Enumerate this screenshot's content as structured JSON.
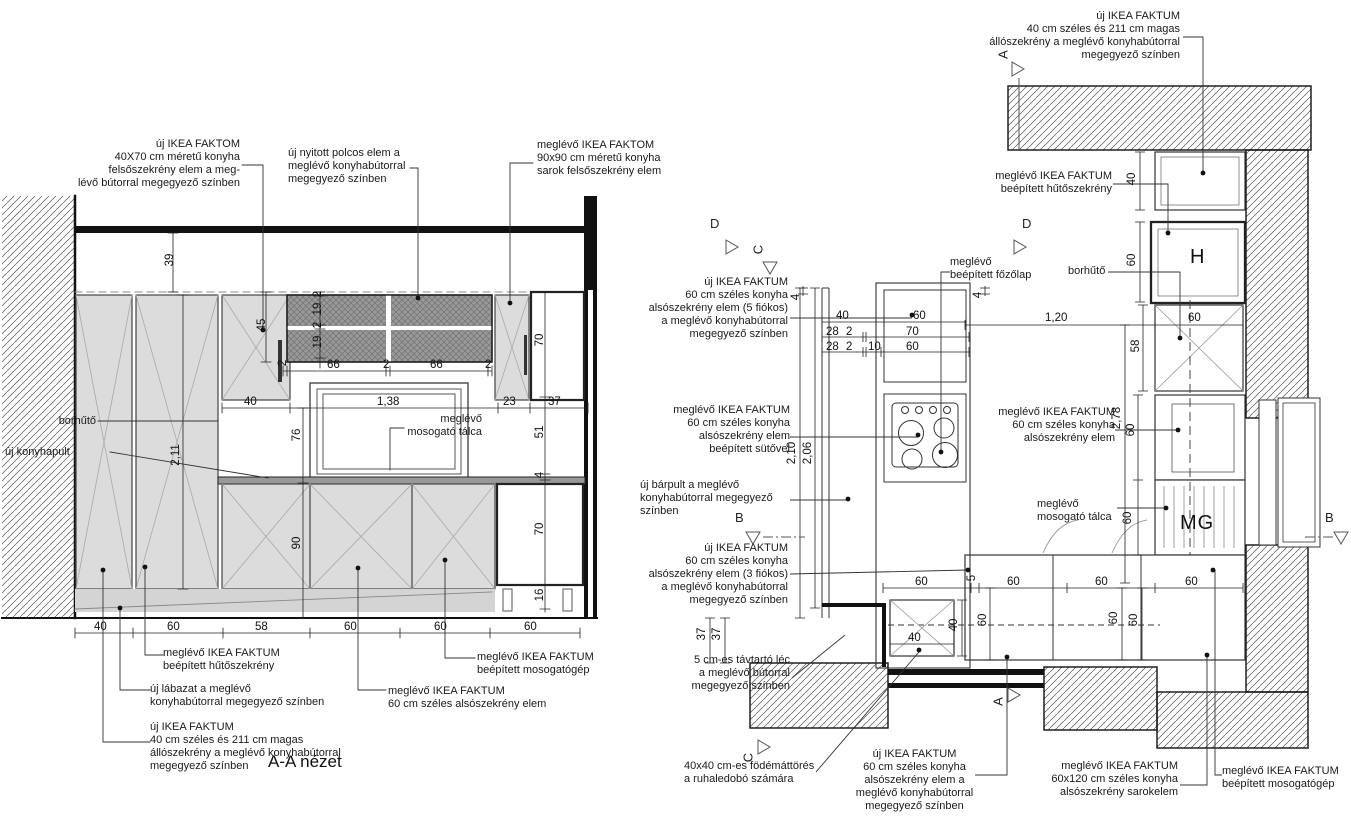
{
  "left": {
    "title": "A-A nézet",
    "ann": {
      "upper40": "új IKEA FAKTOM\n40X70 cm méretű konyha\nfelsőszekrény elem a meg-\nlévő bútorral megegyező színben",
      "openShelf": "új nyitott polcos elem a\nmeglévő konyhabútorral\nmegegyező színben",
      "corner90": "meglévő IKEA FAKTOM\n90x90 cm méretű konyha\nsarok felsőszekrény elem",
      "borhuto": "borhűtő",
      "konyhapult": "új konyhapult",
      "talca": "meglévő\nmosogató tálca",
      "huto": "meglévő IKEA FAKTUM\nbeépített hűtőszekrény",
      "labazat": "új lábazat a meglévő\nkonyhabútorral megegyező színben",
      "allo": "új IKEA FAKTUM\n40 cm széles és 211 cm magas\nállószekrény a meglévő konyhabútorral\nmegegyező színben",
      "mosogep": "meglévő IKEA FAKTUM\nbeépített mosogatógép",
      "also60": "meglévő IKEA FAKTUM\n60 cm széles alsószekrény elem"
    },
    "dims": {
      "v39": "39",
      "v211": "2,11",
      "v45": "45",
      "s2t": "2",
      "s19a": "19",
      "s2a": "2",
      "s19b": "19",
      "h2a": "2",
      "h66a": "66",
      "h2b": "2",
      "h66b": "66",
      "h2c": "2",
      "m40": "40",
      "m138": "1,38",
      "m23": "23",
      "m37": "37",
      "v76": "76",
      "v90": "90",
      "r70a": "70",
      "r51": "51",
      "r4": "4",
      "r70b": "70",
      "r16": "16",
      "b40": "40",
      "b60a": "60",
      "b58": "58",
      "b60b": "60",
      "b60c": "60",
      "b60d": "60"
    }
  },
  "plan": {
    "ann": {
      "tall40": "új IKEA FAKTUM\n40 cm széles és 211 cm magas\nállószekrény a meglévő konyhabútorral\nmegegyező színben",
      "huto": "meglévő IKEA FAKTUM\nbeépített hűtőszekrény",
      "borhuto": "borhűtő",
      "fozolap": "meglévő\nbeépített főzőlap",
      "drawer5": "új IKEA FAKTUM\n60 cm széles konyha\nalsószekrény elem (5 fiókos)\na meglévő konyhabútorral\nmegegyező színben",
      "sutos": "meglévő IKEA FAKTUM\n60 cm széles konyha\nalsószekrény elem\nbeépített sütővel",
      "barpult": "új bárpult a meglévő\nkonyhabútorral megegyező\nszínben",
      "drawer3": "új IKEA FAKTUM\n60 cm széles konyha\nalsószekrény elem (3 fiókos)\na meglévő konyhabútorral\nmegegyező színben",
      "tavtarto": "5 cm-es távtartó léc\na meglévő bútorral\nmegegyező színben",
      "also60": "meglévő IKEA FAKTUM\n60 cm széles konyha\nalsószekrény elem",
      "talca": "meglévő\nmosogató tálca",
      "fodem": "40x40 cm-es födémáttörés\na ruhaledobó számára",
      "also60uj": "új IKEA FAKTUM\n60 cm széles konyha\nalsószekrény elem a\nmeglévő konyhabútorral\nmegegyező színben",
      "sarok": "meglévő IKEA FAKTUM\n60x120 cm széles konyha\nalsószekrény sarokelem",
      "mosogep": "meglévő IKEA FAKTUM\nbeépített mosogatógép"
    },
    "dims": {
      "t40": "40",
      "f60": "60",
      "bor60": "60",
      "d58": "58",
      "d278": "2,78",
      "d120": "1,20",
      "a4": "4",
      "b4": "4",
      "r1a": "40",
      "r1b": "60",
      "r2a": "28",
      "r2b": "2",
      "r2c": "70",
      "r3a": "28",
      "r3b": "2",
      "r3c": "10",
      "r3d": "60",
      "v210": "2,10",
      "v206": "2,06",
      "s60a": "60",
      "s60b": "60",
      "c60a": "60",
      "c5": "5",
      "c60b": "60",
      "c60c": "60",
      "c60d": "60",
      "v60a": "60",
      "v60b": "60",
      "v60c": "60",
      "ch40a": "40",
      "ch40b": "40",
      "w37a": "37",
      "w37b": "37"
    },
    "letters": {
      "H": "H",
      "MG": "MG"
    }
  },
  "markers": {
    "A": "A",
    "B": "B",
    "C": "C",
    "D": "D"
  }
}
